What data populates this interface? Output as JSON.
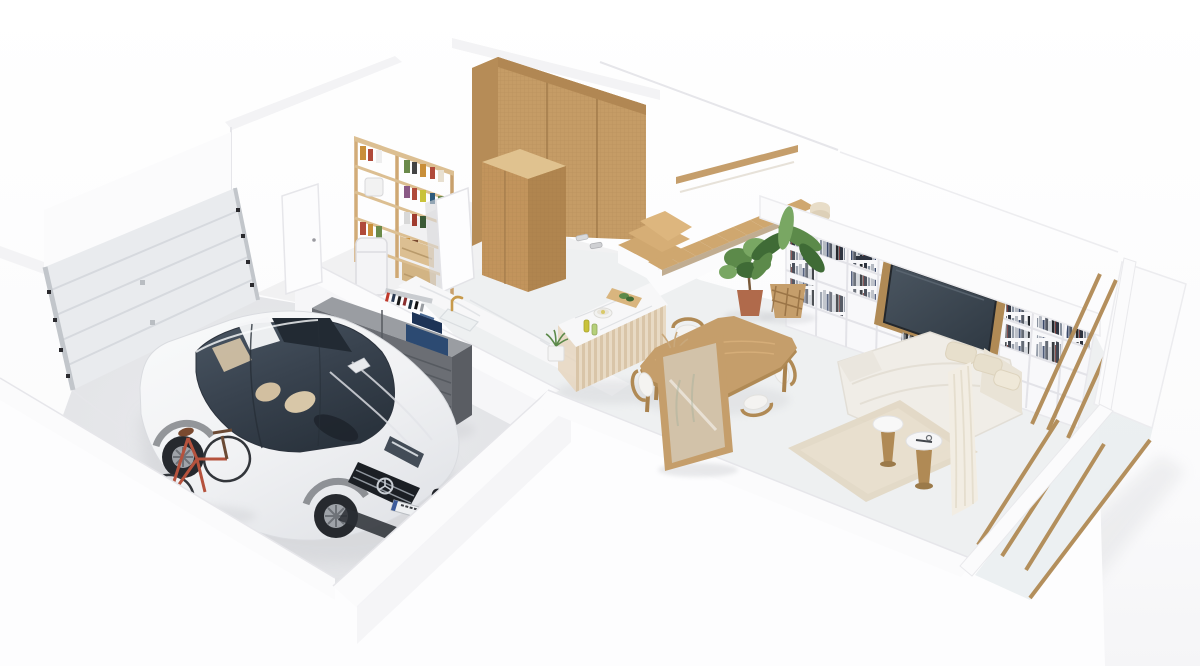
{
  "document_title": "3D Floor Plan Render",
  "scene": {
    "description": "Isometric cutaway 3D render of a house ground floor seen from above: garage with a white sedan, red bicycle and grey tool chest; pantry with wooden shelving; hallway with rattan wardrobes; wooden staircase; kitchen with marble counter and fluted island; wooden dining table with chairs and a framed glass partition; living room with a white bookshelf wall, wall-mounted TV, corner sofa, round side tables and a glazed timber facade on the right.",
    "rooms": [
      {
        "id": "garage",
        "label": "Garage"
      },
      {
        "id": "pantry",
        "label": "Pantry / Storage"
      },
      {
        "id": "hallway",
        "label": "Hallway with Wardrobes"
      },
      {
        "id": "staircase",
        "label": "Staircase"
      },
      {
        "id": "kitchen",
        "label": "Kitchen"
      },
      {
        "id": "dining",
        "label": "Dining Area"
      },
      {
        "id": "living",
        "label": "Living Room"
      }
    ],
    "objects": {
      "garage": [
        "sectional garage door",
        "white sedan car",
        "red bicycle",
        "tool chest with drawers",
        "blue toolboxes",
        "wall tool rack",
        "service door to pantry"
      ],
      "pantry": [
        "wooden pantry shelving with jars and bottles",
        "white pedal bin",
        "wooden crates",
        "open white door"
      ],
      "hallway": [
        "tall rattan wardrobe",
        "small rattan cabinet",
        "slippers on floor"
      ],
      "staircase": [
        "wooden winder steps",
        "straight wooden flight",
        "wall-mounted wooden handrail"
      ],
      "kitchen": [
        "marble wall counter with sink",
        "brass faucet",
        "fluted kitchen island with marble top",
        "cutting board with greens",
        "bowl",
        "oil bottles",
        "small potted plant"
      ],
      "dining": [
        "wooden dining table",
        "six wood-and-white chairs",
        "vase with dried branches",
        "wood-framed glass partition",
        "olive tree in terracotta pot",
        "banana plant in patterned basket"
      ],
      "living": [
        "white bookshelf wall with books",
        "wall TV on wooden panel",
        "record racks",
        "cream corner sofa with cushions",
        "beige rug",
        "two round pedestal side tables",
        "sheer curtain",
        "timber-framed glass facade"
      ]
    }
  },
  "palette": {
    "wall_white": "#fbfbfc",
    "wall_shade": "#f3f3f5",
    "wall_face": "#f6f6f8",
    "wall_edge": "#e6e6ea",
    "floor_garage": "#e3e4e7",
    "floor_main": "#eef0f1",
    "floor_hall": "#f1f1f2",
    "wood": "#c59e6b",
    "wood_dark": "#b08a55",
    "wood_light": "#dcbf92",
    "wood_deep": "#9b7a4a",
    "stair_wood": "#cfa76f",
    "grey_cabinet": "#6b6e74",
    "grey_cabinet_top": "#9a9da2",
    "grey_cabinet_side": "#5a5d63",
    "car_white": "#f4f5f7",
    "glass_dark": "#39434f",
    "glass_darker": "#29323c",
    "interior_beige": "#d8c7a8",
    "wheel_dark": "#26292e",
    "wheel_rim": "#9fa3a9",
    "toolbox_blue": "#2c4a72",
    "toolbox_blue_dark": "#1d3356",
    "bike_red": "#b5523d",
    "marble": "#f7f7f8",
    "marble_vein": "#dfe1e4",
    "island_base": "#e6d6bf",
    "island_flute": "#d9c5a8",
    "gold": "#c79a4b",
    "plant_green": "#5c8a4a",
    "plant_dark": "#3f6b36",
    "plant_light": "#79a763",
    "pot_terracotta": "#b06a4b",
    "basket": "#c59e6b",
    "basket_dark": "#8a6438",
    "sofa": "#f0ede7",
    "sofa_shade": "#e4dfd5",
    "cushion": "#e7dfcc",
    "rug": "#e2d8c5",
    "book_dark": "#2e3440",
    "tv_screen": "#3a444f",
    "tv_frame": "#23272c",
    "glass_pane": "#dfe5e8",
    "curtain": "#f2ede3",
    "door_grey": "#e9ebee",
    "door_grey_dark": "#d6d9de",
    "metal_grey": "#c2c6cb",
    "soft_shadow": "#cfd0d4"
  }
}
